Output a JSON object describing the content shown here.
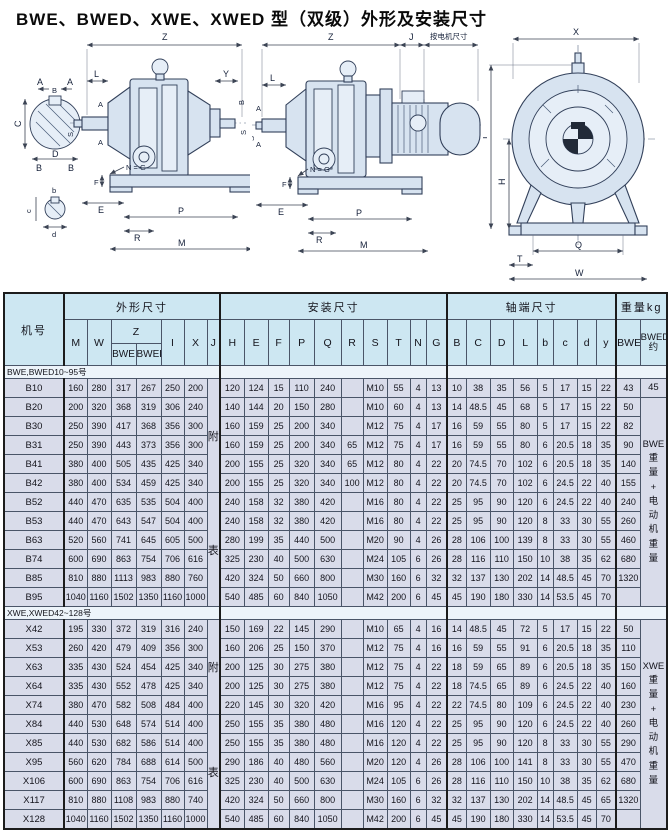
{
  "title": "BWE、BWED、XWE、XWED 型（双级）外形及安装尺寸",
  "drawings": {
    "dims": {
      "Z": "Z",
      "J": "J",
      "motor_note": "按电机尺寸",
      "L": "L",
      "A": "A",
      "Y": "Y",
      "S": "S",
      "B": "B",
      "C": "C",
      "D": "D",
      "b": "b",
      "c": "c",
      "d": "d",
      "NG": "N = G",
      "F": "F",
      "E": "E",
      "P": "P",
      "R": "R",
      "M": "M",
      "X": "X",
      "I": "I",
      "H": "H",
      "Q": "Q",
      "T": "T",
      "W": "W"
    }
  },
  "table": {
    "groups": {
      "machine": "机号",
      "outline": "外形尺寸",
      "install": "安装尺寸",
      "shaft": "轴端尺寸",
      "weight": "重量kg"
    },
    "z_label": "Z",
    "z_sub": [
      "BWE",
      "BWED"
    ],
    "cols_row2": [
      "M",
      "W",
      "Z",
      "I",
      "X",
      "J",
      "H",
      "E",
      "F",
      "P",
      "Q",
      "R",
      "S",
      "T",
      "N",
      "G",
      "B",
      "C",
      "D",
      "L",
      "b",
      "c",
      "d",
      "y",
      "BWE",
      "BWED\n约"
    ],
    "sections": [
      {
        "label": "BWE,BWED10~95号",
        "j_merges": [
          {
            "row": 0,
            "span": 6,
            "text": "附"
          },
          {
            "row": 6,
            "span": 6,
            "text": "表"
          }
        ],
        "bwed_merges": [
          {
            "row": 0,
            "span": 1,
            "text": "45"
          },
          {
            "row": 1,
            "span": 11,
            "text": "BWE\n重\n量\n+\n电\n动\n机\n重\n量"
          }
        ],
        "rows": [
          {
            "model": "B10",
            "v": [
              "160",
              "280",
              "317",
              "267",
              "250",
              "200",
              "120",
              "124",
              "15",
              "110",
              "240",
              "",
              "M10",
              "55",
              "4",
              "13",
              "10",
              "38",
              "35",
              "56",
              "5",
              "17",
              "15",
              "22",
              "43"
            ]
          },
          {
            "model": "B20",
            "v": [
              "200",
              "320",
              "368",
              "319",
              "306",
              "240",
              "140",
              "144",
              "20",
              "150",
              "280",
              "",
              "M10",
              "60",
              "4",
              "13",
              "14",
              "48.5",
              "45",
              "68",
              "5",
              "17",
              "15",
              "22",
              "50"
            ]
          },
          {
            "model": "B30",
            "v": [
              "250",
              "390",
              "417",
              "368",
              "356",
              "300",
              "160",
              "159",
              "25",
              "200",
              "340",
              "",
              "M12",
              "75",
              "4",
              "17",
              "16",
              "59",
              "55",
              "80",
              "5",
              "17",
              "15",
              "22",
              "82"
            ]
          },
          {
            "model": "B31",
            "v": [
              "250",
              "390",
              "443",
              "373",
              "356",
              "300",
              "160",
              "159",
              "25",
              "200",
              "340",
              "65",
              "M12",
              "75",
              "4",
              "17",
              "16",
              "59",
              "55",
              "80",
              "6",
              "20.5",
              "18",
              "35",
              "90"
            ]
          },
          {
            "model": "B41",
            "v": [
              "380",
              "400",
              "505",
              "435",
              "425",
              "340",
              "200",
              "155",
              "25",
              "320",
              "340",
              "65",
              "M12",
              "80",
              "4",
              "22",
              "20",
              "74.5",
              "70",
              "102",
              "6",
              "20.5",
              "18",
              "35",
              "140"
            ]
          },
          {
            "model": "B42",
            "v": [
              "380",
              "400",
              "534",
              "459",
              "425",
              "340",
              "200",
              "155",
              "25",
              "320",
              "340",
              "100",
              "M12",
              "80",
              "4",
              "22",
              "20",
              "74.5",
              "70",
              "102",
              "6",
              "24.5",
              "22",
              "40",
              "155"
            ]
          },
          {
            "model": "B52",
            "v": [
              "440",
              "470",
              "635",
              "535",
              "504",
              "400",
              "240",
              "158",
              "32",
              "380",
              "420",
              "",
              "M16",
              "80",
              "4",
              "22",
              "25",
              "95",
              "90",
              "120",
              "6",
              "24.5",
              "22",
              "40",
              "240"
            ]
          },
          {
            "model": "B53",
            "v": [
              "440",
              "470",
              "643",
              "547",
              "504",
              "400",
              "240",
              "158",
              "32",
              "380",
              "420",
              "",
              "M16",
              "80",
              "4",
              "22",
              "25",
              "95",
              "90",
              "120",
              "8",
              "33",
              "30",
              "55",
              "260"
            ]
          },
          {
            "model": "B63",
            "v": [
              "520",
              "560",
              "741",
              "645",
              "605",
              "500",
              "280",
              "199",
              "35",
              "440",
              "500",
              "",
              "M20",
              "90",
              "4",
              "26",
              "28",
              "106",
              "100",
              "139",
              "8",
              "33",
              "30",
              "55",
              "460"
            ]
          },
          {
            "model": "B74",
            "v": [
              "600",
              "690",
              "863",
              "754",
              "706",
              "616",
              "325",
              "230",
              "40",
              "500",
              "630",
              "",
              "M24",
              "105",
              "6",
              "26",
              "28",
              "116",
              "110",
              "150",
              "10",
              "38",
              "35",
              "62",
              "680"
            ]
          },
          {
            "model": "B85",
            "v": [
              "810",
              "880",
              "1113",
              "983",
              "880",
              "760",
              "420",
              "324",
              "50",
              "660",
              "800",
              "",
              "M30",
              "160",
              "6",
              "32",
              "32",
              "137",
              "130",
              "202",
              "14",
              "48.5",
              "45",
              "70",
              "1320"
            ]
          },
          {
            "model": "B95",
            "v": [
              "1040",
              "1160",
              "1502",
              "1350",
              "1160",
              "1000",
              "540",
              "485",
              "60",
              "840",
              "1050",
              "",
              "M42",
              "200",
              "6",
              "45",
              "45",
              "190",
              "180",
              "330",
              "14",
              "53.5",
              "45",
              "70",
              ""
            ]
          }
        ]
      },
      {
        "label": "XWE,XWED42~128号",
        "j_merges": [
          {
            "row": 0,
            "span": 5,
            "text": "附"
          },
          {
            "row": 5,
            "span": 6,
            "text": "表"
          }
        ],
        "bwed_merges": [
          {
            "row": 0,
            "span": 11,
            "text": "XWE\n重\n量\n+\n电\n动\n机\n重\n量"
          }
        ],
        "rows": [
          {
            "model": "X42",
            "v": [
              "195",
              "330",
              "372",
              "319",
              "316",
              "240",
              "150",
              "169",
              "22",
              "145",
              "290",
              "",
              "M10",
              "65",
              "4",
              "16",
              "14",
              "48.5",
              "45",
              "72",
              "5",
              "17",
              "15",
              "22",
              "50"
            ]
          },
          {
            "model": "X53",
            "v": [
              "260",
              "420",
              "479",
              "409",
              "356",
              "300",
              "160",
              "206",
              "25",
              "150",
              "370",
              "",
              "M12",
              "75",
              "4",
              "16",
              "16",
              "59",
              "55",
              "91",
              "6",
              "20.5",
              "18",
              "35",
              "110"
            ]
          },
          {
            "model": "X63",
            "v": [
              "335",
              "430",
              "524",
              "454",
              "425",
              "340",
              "200",
              "125",
              "30",
              "275",
              "380",
              "",
              "M12",
              "75",
              "4",
              "22",
              "18",
              "59",
              "65",
              "89",
              "6",
              "20.5",
              "18",
              "35",
              "150"
            ]
          },
          {
            "model": "X64",
            "v": [
              "335",
              "430",
              "552",
              "478",
              "425",
              "340",
              "200",
              "125",
              "30",
              "275",
              "380",
              "",
              "M12",
              "75",
              "4",
              "22",
              "18",
              "74.5",
              "65",
              "89",
              "6",
              "24.5",
              "22",
              "40",
              "160"
            ]
          },
          {
            "model": "X74",
            "v": [
              "380",
              "470",
              "582",
              "508",
              "484",
              "400",
              "220",
              "145",
              "30",
              "320",
              "420",
              "",
              "M16",
              "95",
              "4",
              "22",
              "22",
              "74.5",
              "80",
              "109",
              "6",
              "24.5",
              "22",
              "40",
              "230"
            ]
          },
          {
            "model": "X84",
            "v": [
              "440",
              "530",
              "648",
              "574",
              "514",
              "400",
              "250",
              "155",
              "35",
              "380",
              "480",
              "",
              "M16",
              "120",
              "4",
              "22",
              "25",
              "95",
              "90",
              "120",
              "6",
              "24.5",
              "22",
              "40",
              "260"
            ]
          },
          {
            "model": "X85",
            "v": [
              "440",
              "530",
              "682",
              "586",
              "514",
              "400",
              "250",
              "155",
              "35",
              "380",
              "480",
              "",
              "M16",
              "120",
              "4",
              "22",
              "25",
              "95",
              "90",
              "120",
              "8",
              "33",
              "30",
              "55",
              "290"
            ]
          },
          {
            "model": "X95",
            "v": [
              "560",
              "620",
              "784",
              "688",
              "614",
              "500",
              "290",
              "186",
              "40",
              "480",
              "560",
              "",
              "M20",
              "120",
              "4",
              "26",
              "28",
              "106",
              "100",
              "141",
              "8",
              "33",
              "30",
              "55",
              "470"
            ]
          },
          {
            "model": "X106",
            "v": [
              "600",
              "690",
              "863",
              "754",
              "706",
              "616",
              "325",
              "230",
              "40",
              "500",
              "630",
              "",
              "M24",
              "105",
              "6",
              "26",
              "28",
              "116",
              "110",
              "150",
              "10",
              "38",
              "35",
              "62",
              "680"
            ]
          },
          {
            "model": "X117",
            "v": [
              "810",
              "880",
              "1108",
              "983",
              "880",
              "740",
              "420",
              "324",
              "50",
              "660",
              "800",
              "",
              "M30",
              "160",
              "6",
              "32",
              "32",
              "137",
              "130",
              "202",
              "14",
              "48.5",
              "45",
              "65",
              "1320"
            ]
          },
          {
            "model": "X128",
            "v": [
              "1040",
              "1160",
              "1502",
              "1350",
              "1160",
              "1000",
              "540",
              "485",
              "60",
              "840",
              "1050",
              "",
              "M42",
              "200",
              "6",
              "45",
              "45",
              "190",
              "180",
              "330",
              "14",
              "53.5",
              "45",
              "70",
              ""
            ]
          }
        ]
      }
    ]
  }
}
